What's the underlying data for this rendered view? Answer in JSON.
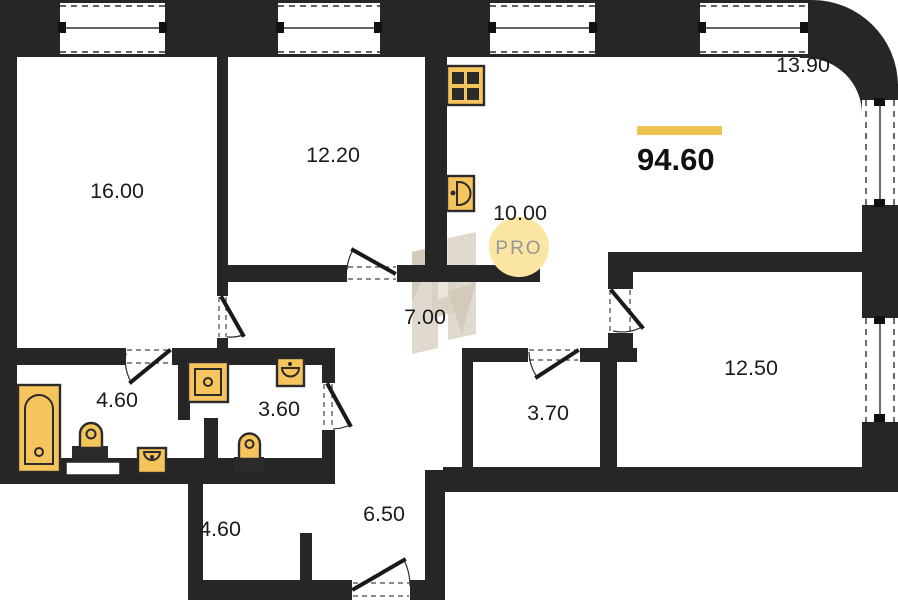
{
  "plan": {
    "total_area": "94.60",
    "watermark_text": "PRO",
    "rooms": [
      {
        "name": "room-16.00",
        "area": "16.00"
      },
      {
        "name": "room-12.20",
        "area": "12.20"
      },
      {
        "name": "living-13.90",
        "area": "13.90"
      },
      {
        "name": "kitchen-10.00",
        "area": "10.00"
      },
      {
        "name": "hall-7.00",
        "area": "7.00"
      },
      {
        "name": "bathroom-4.60",
        "area": "4.60"
      },
      {
        "name": "bathroom-3.60",
        "area": "3.60"
      },
      {
        "name": "wc-3.70",
        "area": "3.70"
      },
      {
        "name": "room-12.50",
        "area": "12.50"
      },
      {
        "name": "corridor-4.60",
        "area": "4.60"
      },
      {
        "name": "hallway-6.50",
        "area": "6.50"
      }
    ],
    "fixtures": [
      "stove-icon",
      "kitchen-sink-icon",
      "bathtub-icon",
      "toilet-icon",
      "washbasin-icon",
      "washing-machine-icon"
    ],
    "colors": {
      "wall": "#262626",
      "fixture": "#F6C45C",
      "fixture_dark": "#2b2b2b",
      "accent_bar": "#F0C24F",
      "watermark_circle": "#FAE5A2",
      "watermark_text": "#95959B",
      "logo_watermark": "#DDD5C8"
    }
  }
}
